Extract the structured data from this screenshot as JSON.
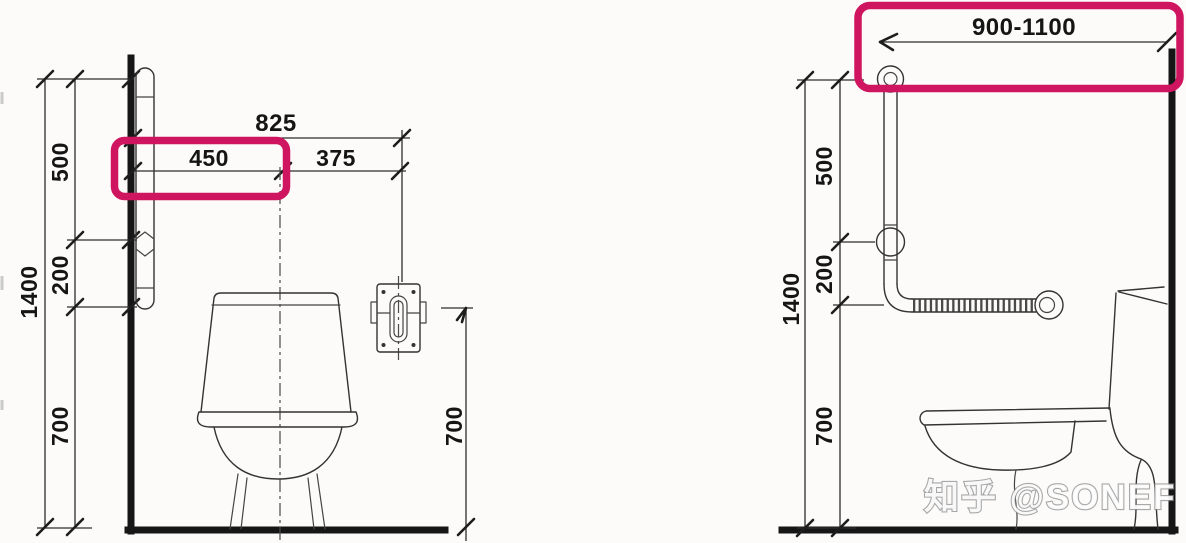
{
  "colors": {
    "highlight_box": "#cf1560",
    "line_art": "#333333",
    "structure": "#161616",
    "background": "#fcfbfa"
  },
  "front_view": {
    "dim_total_height": "1400",
    "dim_upper_segment": "500",
    "dim_mid_segment": "200",
    "dim_lower_segment": "700",
    "dim_overall_width": "825",
    "dim_wall_to_centerline": "450",
    "dim_centerline_to_flush": "375",
    "dim_flush_height": "700"
  },
  "side_view": {
    "dim_total_height": "1400",
    "dim_upper_segment": "500",
    "dim_mid_segment": "200",
    "dim_lower_segment": "700",
    "dim_horizontal_bar_range": "900-1100"
  },
  "watermark": {
    "text": "知乎 @SONEF"
  }
}
